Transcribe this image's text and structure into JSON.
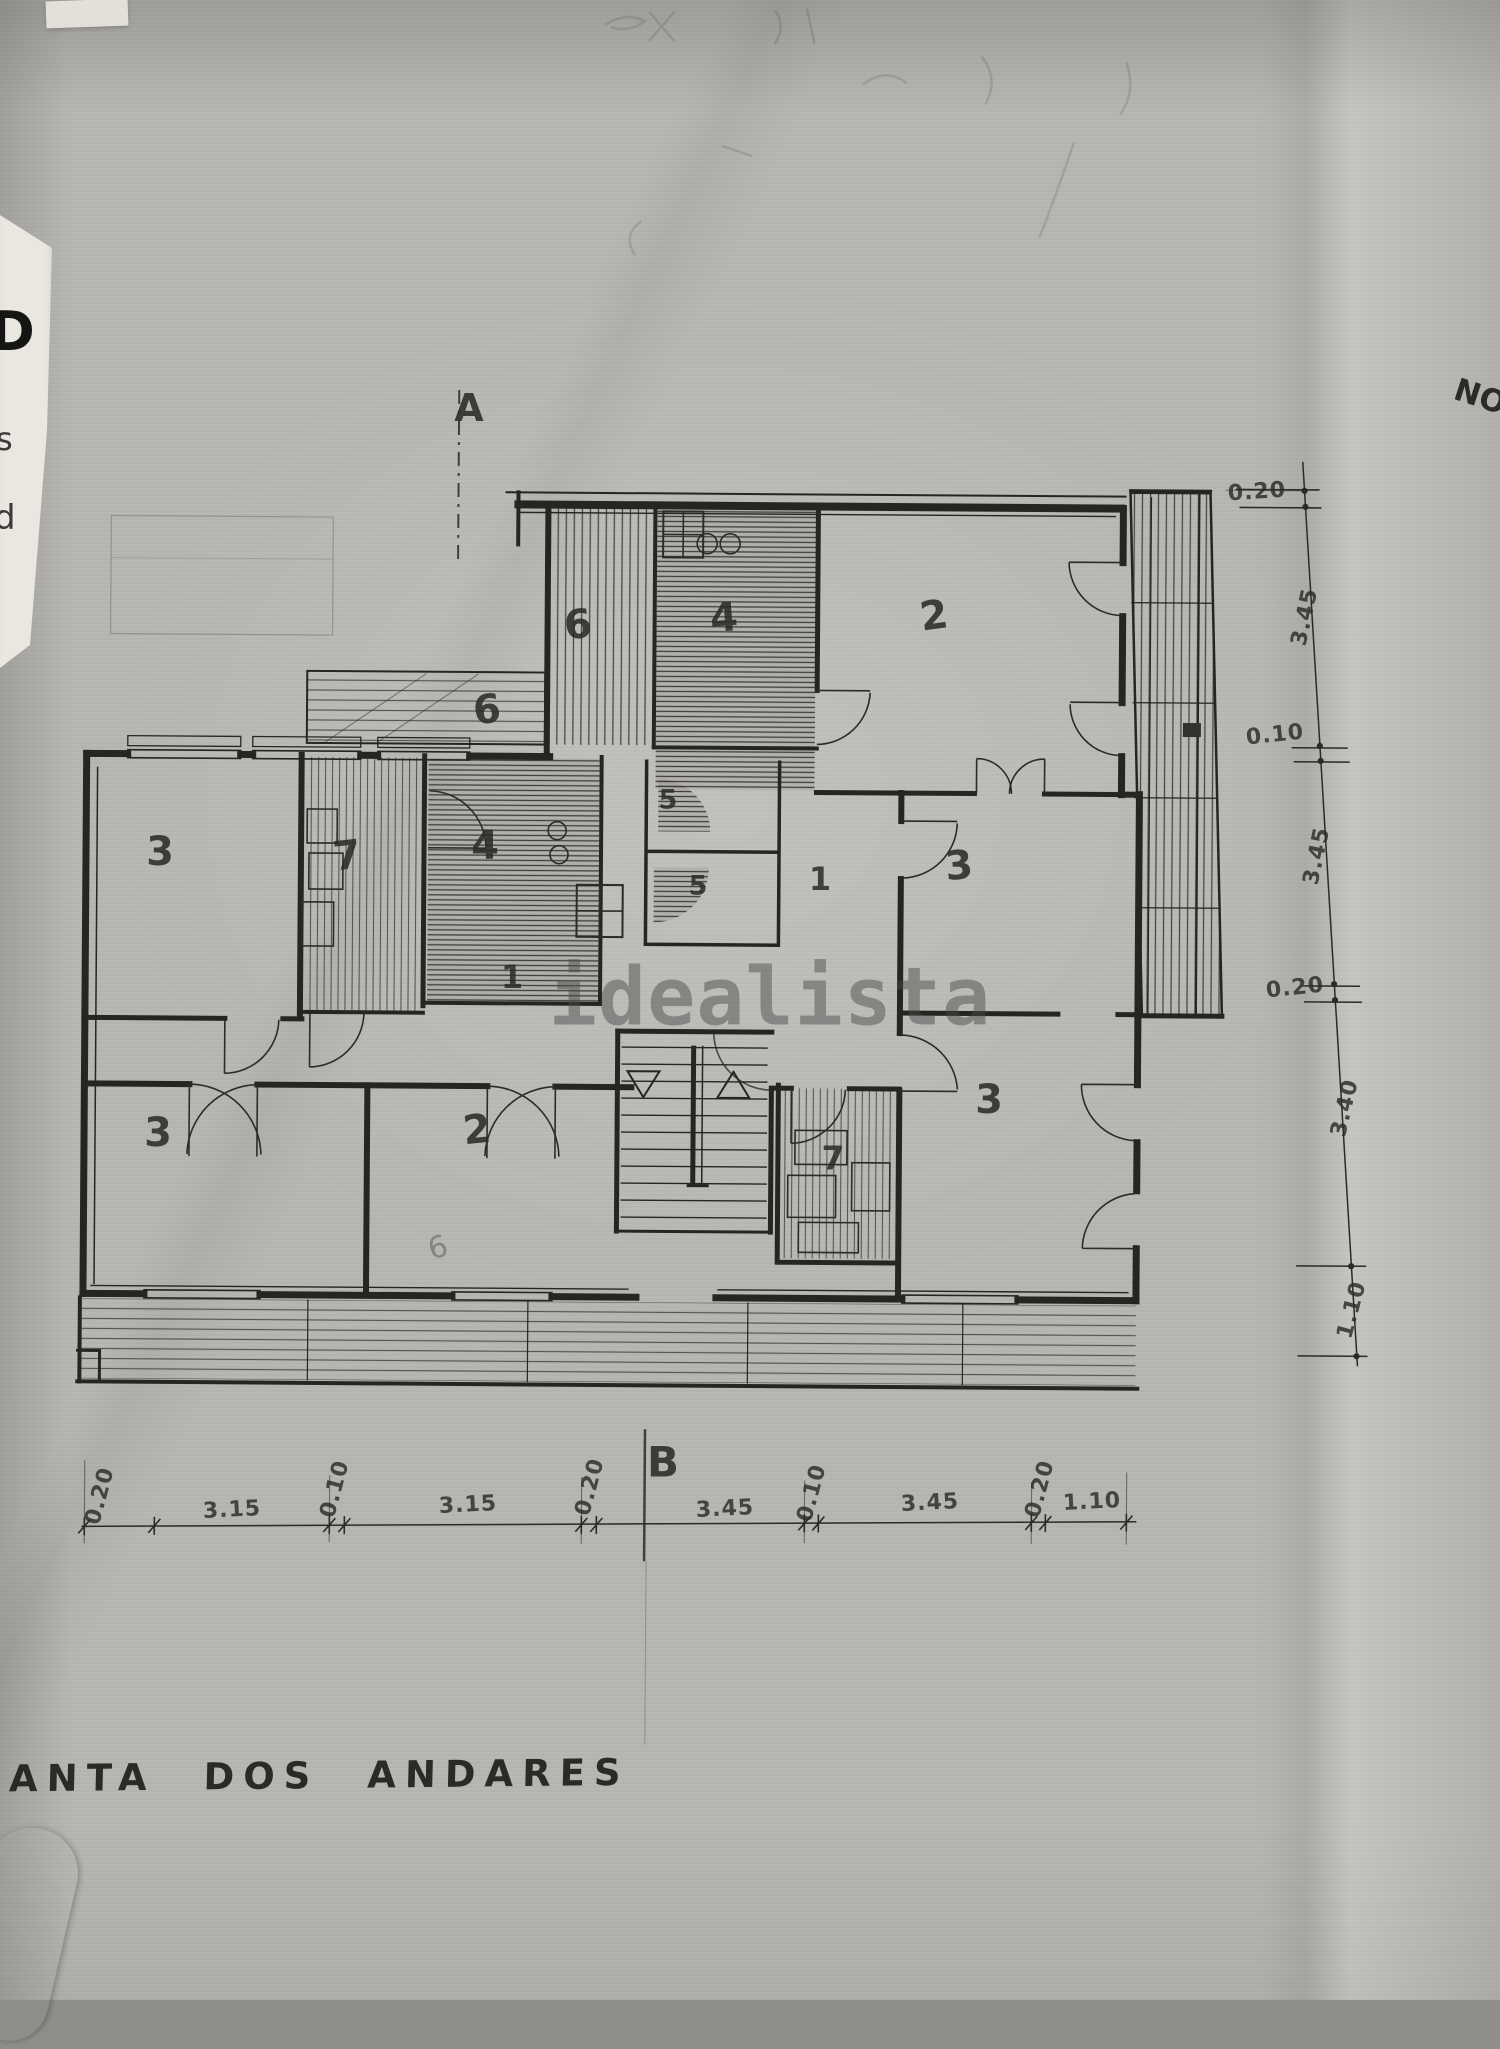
{
  "page": {
    "title": "PLANTA DOS ANDARES",
    "watermark": "idealista",
    "corner_note": "NO",
    "edge_fragments": [
      "D",
      "s",
      "d"
    ]
  },
  "section_markers": {
    "a": "A",
    "b": "B"
  },
  "plan": {
    "room_labels": [
      {
        "value": "6"
      },
      {
        "value": "4"
      },
      {
        "value": "2"
      },
      {
        "value": "6"
      },
      {
        "value": "3"
      },
      {
        "value": "7"
      },
      {
        "value": "4"
      },
      {
        "value": "5"
      },
      {
        "value": "5"
      },
      {
        "value": "1"
      },
      {
        "value": "3"
      },
      {
        "value": "1"
      },
      {
        "value": "3"
      },
      {
        "value": "2"
      },
      {
        "value": "7"
      },
      {
        "value": "3"
      }
    ],
    "pencil_marks": [
      {
        "value": "6"
      }
    ]
  },
  "dimensions": {
    "bottom": [
      "0.20",
      "3.15",
      "0.10",
      "3.15",
      "0.20",
      "3.45",
      "0.10",
      "3.45",
      "0.20",
      "1.10"
    ],
    "right": [
      "0.20",
      "3.45",
      "0.10",
      "3.45",
      "0.20",
      "3.40",
      "1.10"
    ]
  },
  "colors": {
    "paper": "#b7b6b2",
    "ink": "#26251f",
    "watermark_gray": "#4b4b4b"
  }
}
